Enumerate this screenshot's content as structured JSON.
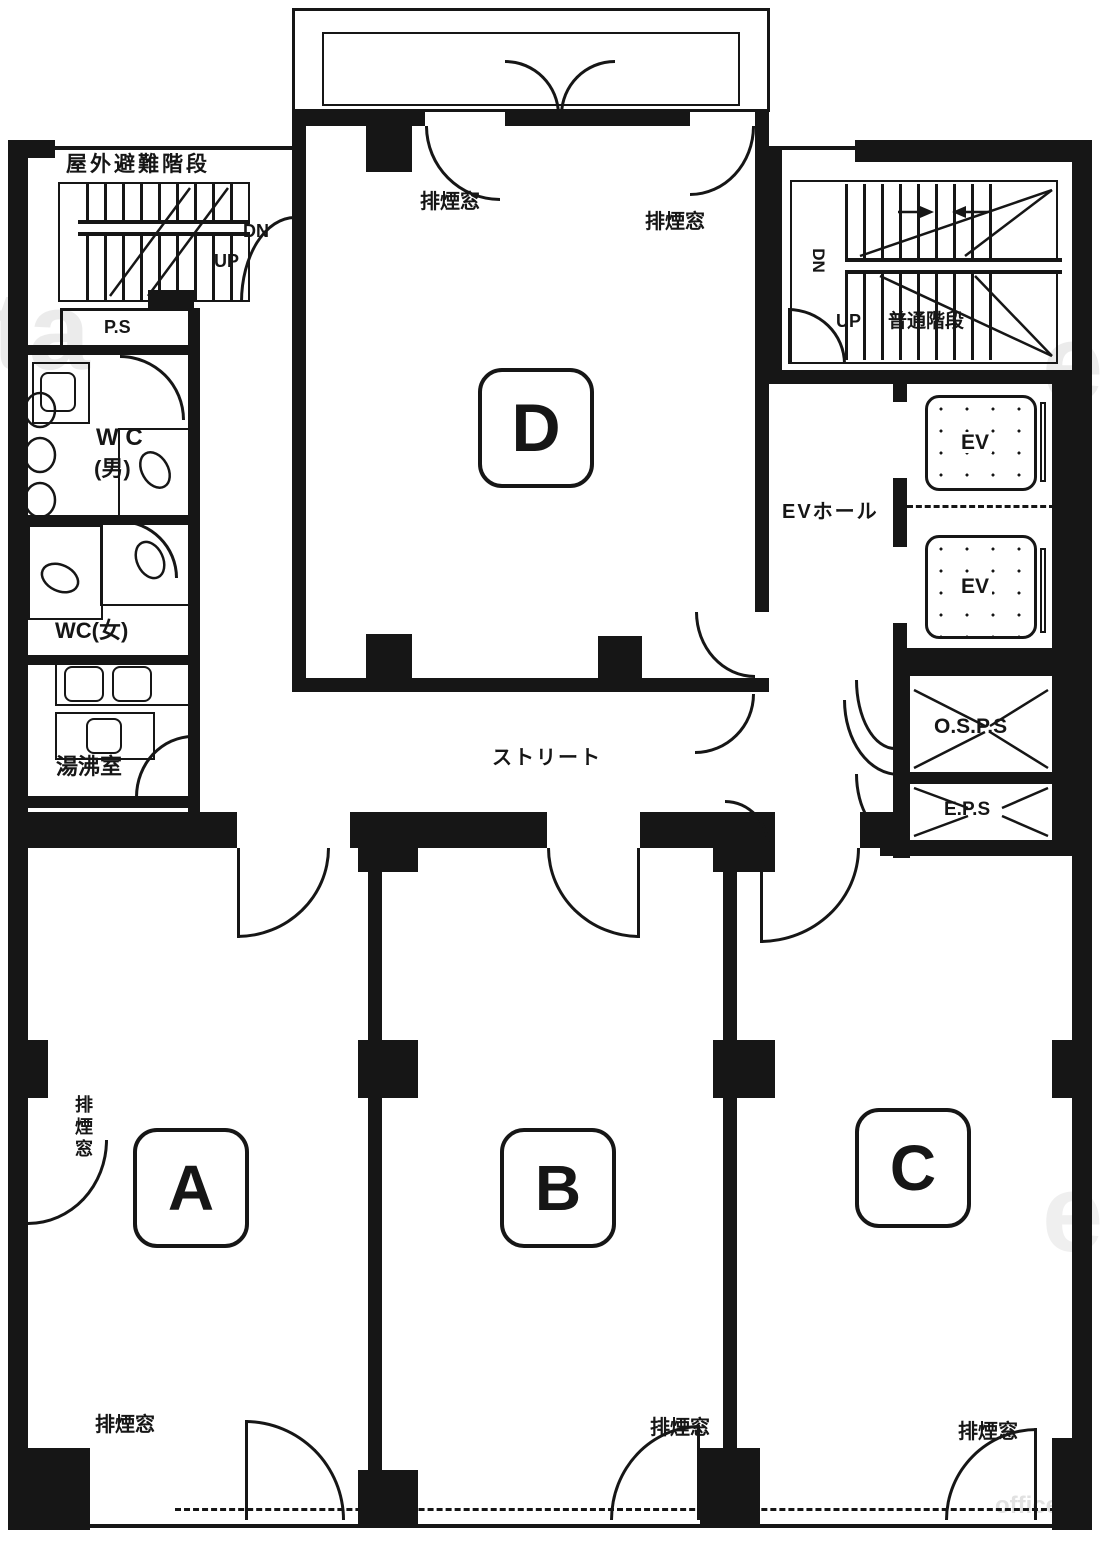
{
  "colors": {
    "ink": "#161616",
    "paper": "#ffffff",
    "watermark": "#d9d9d9"
  },
  "labels": {
    "outdoor_escape_stairs": "屋外避難階段",
    "dn": "DN",
    "up": "UP",
    "ps": "P.S",
    "wc_men_line1": "W C",
    "wc_men_line2": "(男)",
    "wc_women": "WC(女)",
    "kitchenette": "湯沸室",
    "smoke_vent_window": "排煙窓",
    "street_corridor": "ストリート",
    "ordinary_stairs": "普通階段",
    "ev_hall": "EVホール",
    "elevator": "EV",
    "osps": "O.S.P.S",
    "eps": "E.P.S"
  },
  "rooms": {
    "a": "A",
    "b": "B",
    "c": "C",
    "d": "D"
  },
  "watermark": {
    "left_fragment": "ta",
    "right_fragment": "e",
    "corner": "office"
  }
}
